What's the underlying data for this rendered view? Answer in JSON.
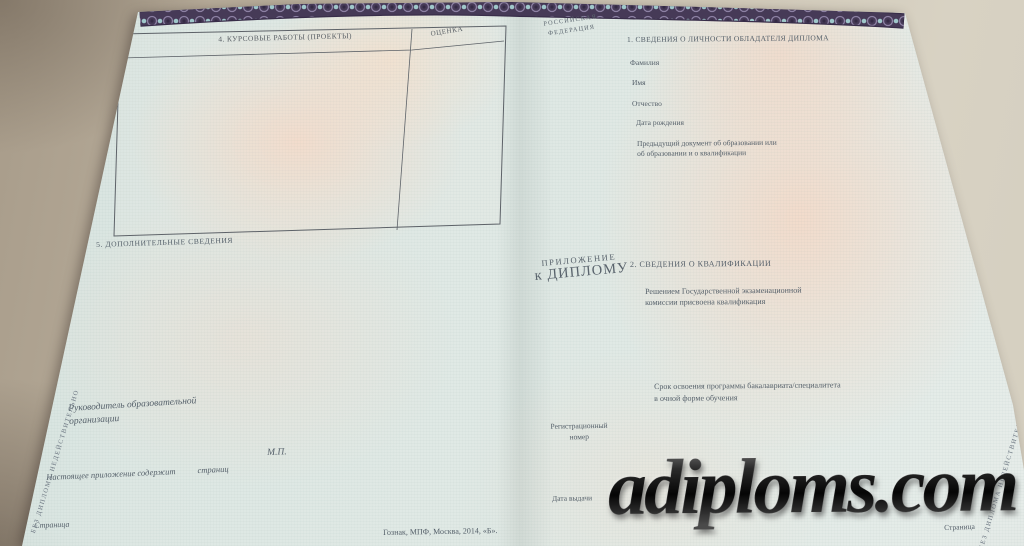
{
  "colors": {
    "desk": "#c3b9a7",
    "paper_tint": "#dfe8e4",
    "pink_tint": "#f3ddcf",
    "band_base": "#463a57",
    "band_accent": "#a9d6d6",
    "emblem_gold": "#c9a646",
    "ink": "#545f69",
    "watermark_ink": "#1f1f1f"
  },
  "left_page": {
    "coursework_table": {
      "title": "4. КУРСОВЫЕ РАБОТЫ (ПРОЕКТЫ)",
      "grade_column": "ОЦЕНКА"
    },
    "additional_info_title": "5. ДОПОЛНИТЕЛЬНЫЕ СВЕДЕНИЯ",
    "head_of_org_line1": "Руководитель образовательной",
    "head_of_org_line2": "организации",
    "seal": "М.П.",
    "pages_note": "Настоящее приложение содержит",
    "pages_note_unit": "страниц",
    "page_label": "Страница",
    "printer_imprint": "Гознак, МПФ, Москва, 2014, «Б»."
  },
  "center_fold": {
    "country_line1": "РОССИЙСКАЯ",
    "country_line2": "ФЕДЕРАЦИЯ",
    "emblem_name": "russian-coat-of-arms-double-headed-eagle",
    "doc_title_line1": "ПРИЛОЖЕНИЕ",
    "doc_title_line2": "к ДИПЛОМУ",
    "reg_number_line1": "Регистрационный",
    "reg_number_line2": "номер",
    "issue_date_label": "Дата выдачи"
  },
  "right_page": {
    "personal_section_title": "1. СВЕДЕНИЯ О ЛИЧНОСТИ ОБЛАДАТЕЛЯ ДИПЛОМА",
    "surname_label": "Фамилия",
    "given_name_label": "Имя",
    "patronymic_label": "Отчество",
    "birth_date_label": "Дата рождения",
    "previous_document_line1": "Предыдущий документ об образовании или",
    "previous_document_line2": "об образовании и о квалификации",
    "qualification_section_title": "2. СВЕДЕНИЯ О КВАЛИФИКАЦИИ",
    "qualification_line1": "Решением Государственной экзаменационной",
    "qualification_line2": "комиссии присвоена квалификация",
    "program_duration_line1": "Срок освоения программы бакалавриата/специалитета",
    "program_duration_line2": "в очной форме обучения",
    "page_label": "Страница"
  },
  "security": {
    "edge_text_left": "БЕЗ ДИПЛОМА НЕДЕЙСТВИТЕЛЬНО",
    "edge_text_right": "БЕЗ ДИПЛОМА НЕДЕЙСТВИТЕЛЬНО"
  },
  "watermark": {
    "text": "adiploms.com"
  }
}
